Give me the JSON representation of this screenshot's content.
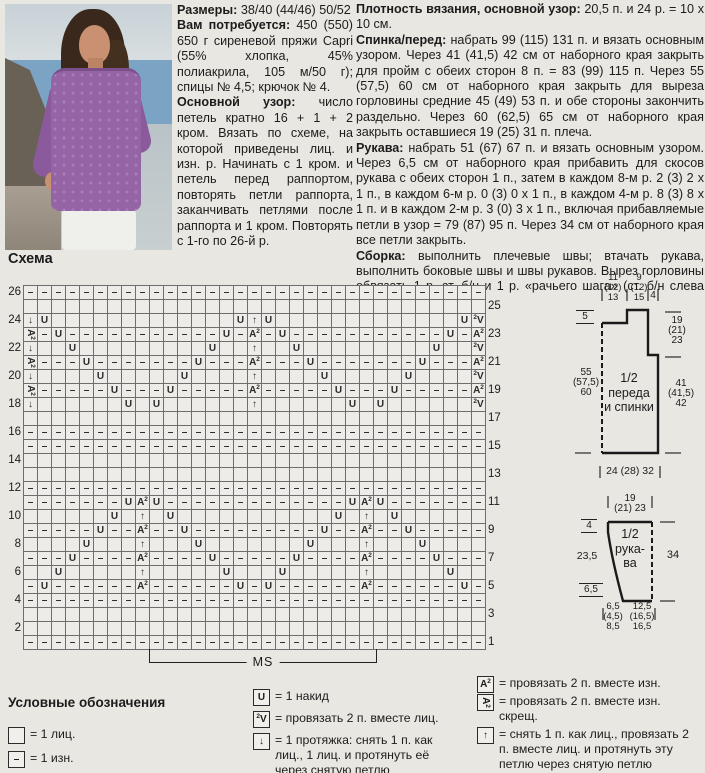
{
  "schema_label": "Схема",
  "materials": {
    "paragraphs": [
      {
        "lead": "Размеры:",
        "text": "38/40 (44/46) 50/52"
      },
      {
        "lead": "Вам потребуется:",
        "text": "450 (550) 650 г сиреневой пряжи Capri (55% хлопка, 45% полиакрила, 105 м/50 г); спицы № 4,5; крючок № 4."
      },
      {
        "lead": "Основной узор:",
        "text": "число петель кратно 16 + 1 + 2 кром. Вязать по схеме, на которой приведены лиц. и изн. р. Начинать с 1 кром. и петель перед раппортом, повторять петли раппорта, заканчивать петлями после раппорта и 1 кром. Повторять с 1-го по 26-й р."
      }
    ]
  },
  "instructions": {
    "paragraphs": [
      {
        "lead": "Плотность вязания, основной узор:",
        "text": "20,5 п. и 24 р. = 10 х 10 см."
      },
      {
        "lead": "Спинка/перед:",
        "text": "набрать 99 (115) 131 п. и вязать основным узором. Через 41 (41,5) 42 см от наборного края закрыть для пройм с обеих сторон 8 п. = 83 (99) 115 п. Через 55 (57,5) 60 см от наборного края закрыть для выреза горловины средние 45 (49) 53 п. и обе стороны закончить раздельно. Через 60 (62,5) 65 см от наборного края закрыть оставшиеся 19 (25) 31 п. плеча."
      },
      {
        "lead": "Рукава:",
        "text": "набрать 51 (67) 67 п. и вязать основным узором. Через 6,5 см от наборного края прибавить для скосов рукава с обеих сторон 1 п., затем в каждом 8-м р. 2 (3) 2 х 1 п., в каждом 6-м р. 0 (3) 0 х 1 п., в каждом 4-м р. 8 (3) 8 х 1 п. и в каждом 2-м р. 3 (0) 3 х 1 п., включая прибавляемые петли в узор = 79 (87) 95 п. Через 34 см от наборного края все петли закрыть."
      },
      {
        "lead": "Сборка:",
        "text": "выполнить плечевые швы; втачать рукава, выполнить боковые швы и швы рукавов. Вырез горловины обвязать 1 р. ст. б/н и 1 р. «рачьего шага» (ст. б/н слева направо)."
      }
    ]
  },
  "chart_data": {
    "type": "heatmap",
    "title": "Схема",
    "columns": 33,
    "repeat_label": "MS",
    "repeat_columns": [
      10,
      25
    ],
    "symbol_key": {
      ".": "1 лиц.",
      "-": "1 изн.",
      "U": "1 накид",
      "V": "провязать 2 п. вместе лиц.",
      "S": "1 протяжка",
      "A": "провязать 2 п. вместе изн.",
      "Z": "провязать 2 п. вместе изн. скрещ.",
      "T": "снять 1 п. как лиц., провязать 2 п. вместе лиц. и протянуть эту петлю через снятую петлю"
    },
    "rows": [
      {
        "n": 26,
        "c": "---------------------------------"
      },
      {
        "n": 25,
        "c": "................................."
      },
      {
        "n": 24,
        "c": "SU.............UTU.............UV"
      },
      {
        "n": 23,
        "c": "Z-U-----------U-A-U-----------U-A"
      },
      {
        "n": 22,
        "c": "S..U.........U..T..U.........U..V"
      },
      {
        "n": 21,
        "c": "Z---U-------U---A---U-------U---A"
      },
      {
        "n": 20,
        "c": "S....U.....U....T....U.....U....V"
      },
      {
        "n": 19,
        "c": "Z-----U---U-----A-----U---U-----A"
      },
      {
        "n": 18,
        "c": "S......U.U......T......U.U......V"
      },
      {
        "n": 17,
        "c": "................................."
      },
      {
        "n": 16,
        "c": "---------------------------------"
      },
      {
        "n": 15,
        "c": "---------------------------------"
      },
      {
        "n": 14,
        "c": "................................."
      },
      {
        "n": 13,
        "c": "................................."
      },
      {
        "n": 12,
        "c": "---------------------------------"
      },
      {
        "n": 11,
        "c": "-------UAU-------------UAU-------"
      },
      {
        "n": 10,
        "c": "......U.T.U...........U.T.U......"
      },
      {
        "n": 9,
        "c": "-----U--A--U---------U--A--U-----"
      },
      {
        "n": 8,
        "c": "....U...T...U.......U...T...U...."
      },
      {
        "n": 7,
        "c": "---U----A----U-----U----A----U---"
      },
      {
        "n": 6,
        "c": "..U.....T.....U...U.....T.....U.."
      },
      {
        "n": 5,
        "c": "-U------A------U-U------A------U-"
      },
      {
        "n": 4,
        "c": "---------------------------------"
      },
      {
        "n": 3,
        "c": "................................."
      },
      {
        "n": 2,
        "c": "................................."
      },
      {
        "n": 1,
        "c": "---------------------------------"
      }
    ]
  },
  "legend": {
    "title": "Условные обозначения",
    "col1": [
      {
        "sym": "K",
        "text": "= 1 лиц."
      },
      {
        "sym": "-",
        "text": "= 1 изн."
      }
    ],
    "col2": [
      {
        "sym": "U",
        "text": "= 1 накид"
      },
      {
        "sym": "V",
        "text": "= провязать 2 п. вместе лиц."
      },
      {
        "sym": "S",
        "text": "= 1 протяжка: снять 1 п. как лиц., 1 лиц. и протянуть её через снятую петлю"
      }
    ],
    "col3": [
      {
        "sym": "A",
        "text": "= провязать 2 п. вместе изн."
      },
      {
        "sym": "Z",
        "text": "= провязать 2 п. вместе изн. скрещ."
      },
      {
        "sym": "T",
        "text": "= снять 1 п. как лиц., провязать 2 п. вместе лиц. и протянуть эту петлю через снятую петлю"
      }
    ]
  },
  "schematics": {
    "body": {
      "name": [
        "1/2",
        "переда",
        "и спинки"
      ],
      "top_left": [
        "11",
        "(12)",
        "13"
      ],
      "top_mid": [
        "9",
        "(12)",
        "15"
      ],
      "top_right": "4",
      "neck_depth": "5",
      "armhole": [
        "19",
        "(21)",
        "23"
      ],
      "side_height": [
        "55",
        "(57,5)",
        "60"
      ],
      "to_armhole": [
        "41",
        "(41,5)",
        "42"
      ],
      "bottom": "24 (28) 32"
    },
    "sleeve": {
      "name": [
        "1/2",
        "рука-",
        "ва"
      ],
      "top1": "19",
      "top2": "(21) 23",
      "cap": "4",
      "upper": "23,5",
      "cuff": "6,5",
      "length": "34",
      "bottom_left": [
        "6,5",
        "(4,5)",
        "8,5"
      ],
      "bottom_right": [
        "12,5",
        "(16,5)",
        "16,5"
      ]
    }
  },
  "photo": {
    "colors": {
      "sweater": "#9464a5",
      "hair": "#3a281d",
      "skin": "#c99071",
      "sea": "#7aa3c4",
      "rock": "#6a6156",
      "pants": "#efefec"
    }
  }
}
